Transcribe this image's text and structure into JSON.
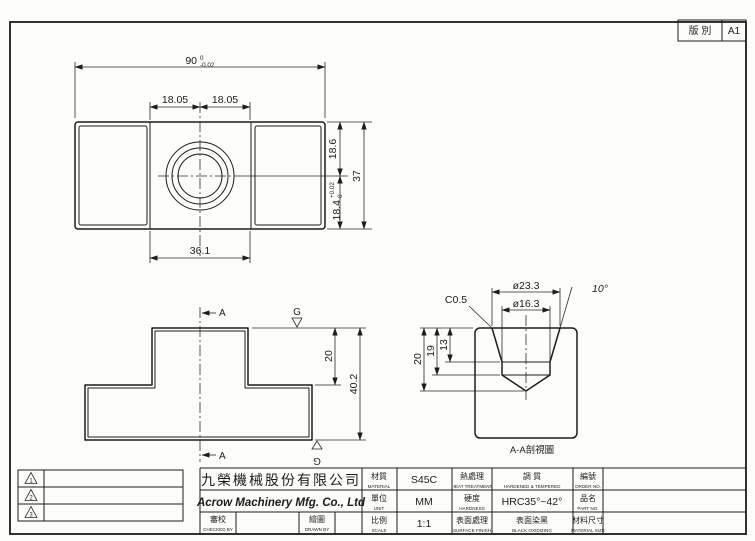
{
  "revision_box": {
    "label": "版 別",
    "value": "A1"
  },
  "revisions": [
    "1",
    "2",
    "3"
  ],
  "views": {
    "top": {
      "dim_width": "90",
      "dim_width_tol_upper": "0",
      "dim_width_tol_lower": "-0.02",
      "dim_left_offset": "18.05",
      "dim_right_offset": "18.05",
      "dim_height_upper": "18.6",
      "dim_height_total": "37",
      "dim_slot": "18.4",
      "dim_slot_tol_upper": "+0.02",
      "dim_slot_tol_lower": "0",
      "dim_boss": "36.1"
    },
    "front": {
      "section_mark_top": "A",
      "section_mark_bottom": "A",
      "grind_mark_top": "G",
      "grind_mark_bottom": "G",
      "dim_step": "20",
      "dim_total_height": "40.2"
    },
    "section": {
      "caption": "A-A剖視圖",
      "dim_chamfer": "C0.5",
      "dim_outer_dia": "ø23.3",
      "dim_inner_dia": "ø16.3",
      "dim_angle": "10°",
      "dim_depth_taper": "13",
      "dim_depth_bore": "19",
      "dim_depth_tip": "20"
    }
  },
  "title_block": {
    "company_zh": "九榮機械股份有限公司",
    "company_en": "Acrow Machinery Mfg. Co., Ltd",
    "checked": {
      "zh": "審校",
      "en": "CHECKED BY"
    },
    "drawn": {
      "zh": "繪圖",
      "en": "DRAWN BY"
    },
    "material": {
      "zh": "材質",
      "en": "MATERIAL",
      "value": "S45C"
    },
    "unit": {
      "zh": "單位",
      "en": "UNIT",
      "value": "MM"
    },
    "scale": {
      "zh": "比例",
      "en": "SCALE",
      "value": "1:1"
    },
    "heat": {
      "zh": "熱處理",
      "en": "HEAT TREATMENT",
      "value_zh": "調 質",
      "value_en": "HARDENED & TEMPERED"
    },
    "hardness": {
      "zh": "硬度",
      "en": "HARDNESS",
      "value": "HRC35°~42°"
    },
    "surface": {
      "zh": "表面處理",
      "en": "SURFACE FINISH",
      "value_zh": "表面染黑",
      "value_en": "BLACK OXIDIZING"
    },
    "order": {
      "zh": "編號",
      "en": "ORDER NO."
    },
    "part": {
      "zh": "品名",
      "en": "PART NO."
    },
    "mat_size": {
      "zh": "材料尺寸",
      "en": "MATERIAL SIZE"
    }
  }
}
